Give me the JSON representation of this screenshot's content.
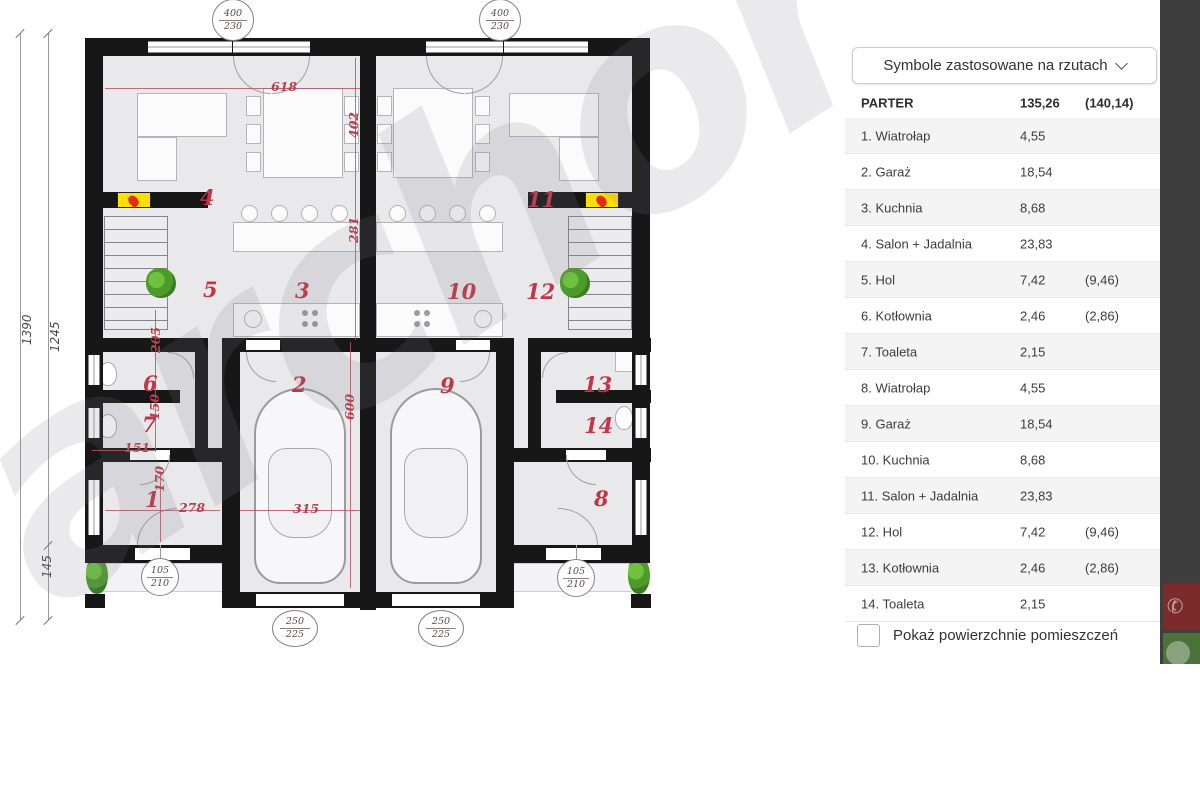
{
  "side_panel": {
    "dropdown_label": "Symbole zastosowane na rzutach",
    "dropdown_icon": "chevron-down",
    "header": {
      "label": "PARTER",
      "area": "135,26",
      "area_alt": "(140,14)"
    },
    "rows": [
      {
        "num": "1.",
        "name": "Wiatrołap",
        "area": "4,55",
        "area_alt": ""
      },
      {
        "num": "2.",
        "name": "Garaż",
        "area": "18,54",
        "area_alt": ""
      },
      {
        "num": "3.",
        "name": "Kuchnia",
        "area": "8,68",
        "area_alt": ""
      },
      {
        "num": "4.",
        "name": "Salon + Jadalnia",
        "area": "23,83",
        "area_alt": ""
      },
      {
        "num": "5.",
        "name": "Hol",
        "area": "7,42",
        "area_alt": "(9,46)"
      },
      {
        "num": "6.",
        "name": "Kotłownia",
        "area": "2,46",
        "area_alt": "(2,86)"
      },
      {
        "num": "7.",
        "name": "Toaleta",
        "area": "2,15",
        "area_alt": ""
      },
      {
        "num": "8.",
        "name": "Wiatrołap",
        "area": "4,55",
        "area_alt": ""
      },
      {
        "num": "9.",
        "name": "Garaż",
        "area": "18,54",
        "area_alt": ""
      },
      {
        "num": "10.",
        "name": "Kuchnia",
        "area": "8,68",
        "area_alt": ""
      },
      {
        "num": "11.",
        "name": "Salon + Jadalnia",
        "area": "23,83",
        "area_alt": ""
      },
      {
        "num": "12.",
        "name": "Hol",
        "area": "7,42",
        "area_alt": "(9,46)"
      },
      {
        "num": "13.",
        "name": "Kotłownia",
        "area": "2,46",
        "area_alt": "(2,86)"
      },
      {
        "num": "14.",
        "name": "Toaleta",
        "area": "2,15",
        "area_alt": ""
      }
    ],
    "checkbox_label": "Pokaż powierzchnie pomieszczeń",
    "checkbox_checked": false
  },
  "overlay_buttons": {
    "phone_icon": "✆",
    "chat_icon": "chat-bubble"
  },
  "floor_plan": {
    "watermark": "archon",
    "room_numbers": [
      {
        "t": "4",
        "x": 200,
        "y": 185
      },
      {
        "t": "11",
        "x": 527,
        "y": 187
      },
      {
        "t": "5",
        "x": 203,
        "y": 277
      },
      {
        "t": "3",
        "x": 295,
        "y": 278
      },
      {
        "t": "10",
        "x": 447,
        "y": 279
      },
      {
        "t": "12",
        "x": 526,
        "y": 279
      },
      {
        "t": "6",
        "x": 143,
        "y": 371
      },
      {
        "t": "2",
        "x": 292,
        "y": 372
      },
      {
        "t": "9",
        "x": 440,
        "y": 373
      },
      {
        "t": "13",
        "x": 583,
        "y": 372
      },
      {
        "t": "7",
        "x": 142,
        "y": 412
      },
      {
        "t": "14",
        "x": 584,
        "y": 413
      },
      {
        "t": "1",
        "x": 145,
        "y": 487
      },
      {
        "t": "8",
        "x": 594,
        "y": 486
      }
    ],
    "dimensions_red": [
      {
        "t": "618",
        "x": 271,
        "y": 79,
        "rot": 0
      },
      {
        "t": "402",
        "x": 346,
        "y": 138,
        "rot": -90
      },
      {
        "t": "281",
        "x": 346,
        "y": 243,
        "rot": -90
      },
      {
        "t": "600",
        "x": 342,
        "y": 420,
        "rot": -90
      },
      {
        "t": "315",
        "x": 293,
        "y": 501,
        "rot": 0
      },
      {
        "t": "278",
        "x": 179,
        "y": 500,
        "rot": 0
      },
      {
        "t": "170",
        "x": 152,
        "y": 492,
        "rot": -90
      },
      {
        "t": "151",
        "x": 124,
        "y": 440,
        "rot": 0
      },
      {
        "t": "150",
        "x": 147,
        "y": 420,
        "rot": -90
      },
      {
        "t": "205",
        "x": 148,
        "y": 353,
        "rot": -90
      }
    ],
    "dimensions_gray": [
      {
        "t": "1390",
        "x": 20,
        "y": 345,
        "rot": -90
      },
      {
        "t": "1245",
        "x": 48,
        "y": 352,
        "rot": -90
      },
      {
        "t": "145",
        "x": 40,
        "y": 578,
        "rot": -90
      }
    ],
    "window_symbols": [
      {
        "top": "400",
        "bottom": "230",
        "x": 233,
        "y": 20,
        "w": 42,
        "h": 42
      },
      {
        "top": "400",
        "bottom": "230",
        "x": 500,
        "y": 20,
        "w": 42,
        "h": 42
      },
      {
        "top": "105",
        "bottom": "210",
        "x": 160,
        "y": 577,
        "w": 38,
        "h": 38
      },
      {
        "top": "105",
        "bottom": "210",
        "x": 576,
        "y": 578,
        "w": 38,
        "h": 38
      },
      {
        "top": "250",
        "bottom": "225",
        "x": 295,
        "y": 628,
        "w": 46,
        "h": 37
      },
      {
        "top": "250",
        "bottom": "225",
        "x": 441,
        "y": 628,
        "w": 46,
        "h": 37
      }
    ],
    "colors": {
      "room_number": "#c23648",
      "dimension_red": "#b9404f",
      "fireplace": "#ffdf00",
      "plant": "#4d9b2a"
    }
  }
}
